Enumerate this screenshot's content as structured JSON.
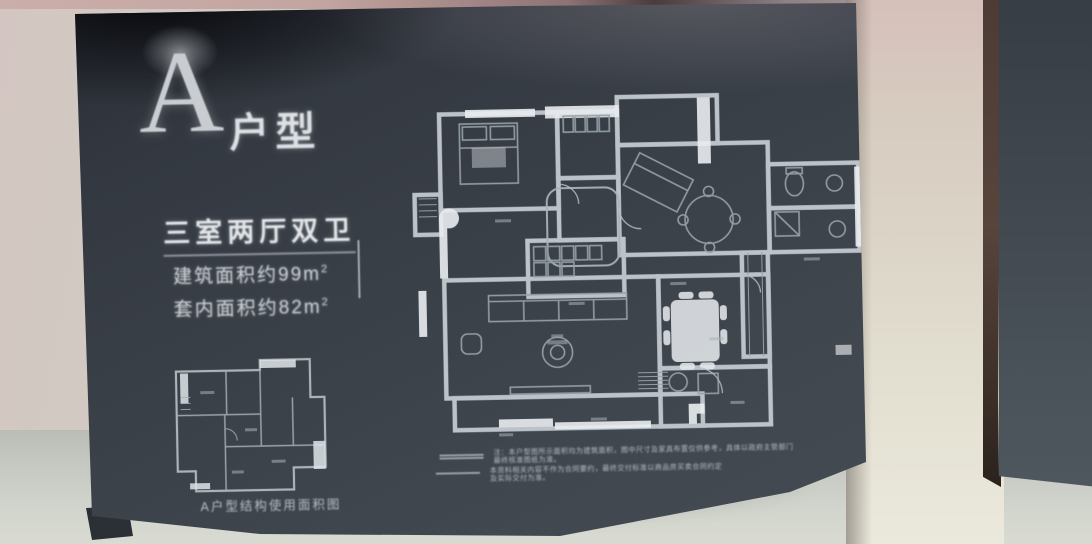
{
  "board": {
    "title_letter": "A",
    "title_suffix": "户型",
    "layout_title": "三室两厅双卫",
    "area_lines": [
      {
        "text": "建筑面积约99m",
        "sup": "2"
      },
      {
        "text": "套内面积约82m",
        "sup": "2"
      }
    ],
    "small_plan_caption": "A户型结构使用面积图",
    "disclaimer": [
      {
        "text": "注：本户型图所示面积均为建筑面积，图中尺寸及家具布置仅供参考，具体以政府主管部门最终核准图纸为准。"
      },
      {
        "text": "本资料相关内容不作为合同要约，最终交付标准以商品房买卖合同约定及实际交付为准。"
      }
    ]
  },
  "colors": {
    "board_bg": "#3b414a",
    "plan_line": "#d8dde1",
    "bright_wall": "#e9edf0",
    "wall": "#d3cbc2"
  }
}
